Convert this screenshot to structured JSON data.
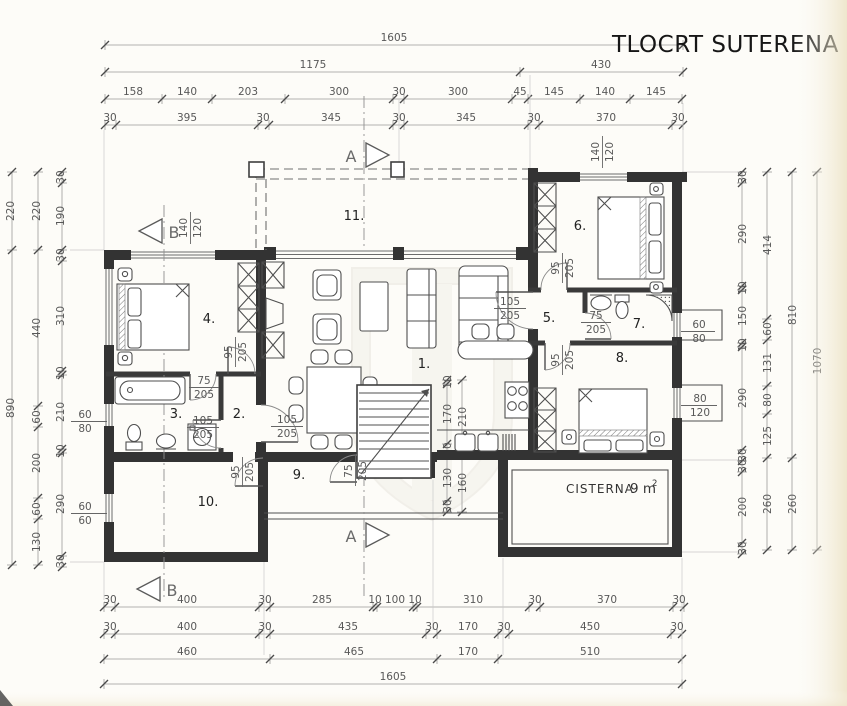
{
  "title": "TLOCRT SUTERENA 1:10",
  "colors": {
    "ink": "#333333",
    "dim_text": "#585858",
    "paper": "#fdfcf8"
  },
  "rooms": [
    "1.",
    "2.",
    "3.",
    "4.",
    "5.",
    "6.",
    "7.",
    "8.",
    "9.",
    "10.",
    "11."
  ],
  "sections": {
    "a": "A",
    "b": "B"
  },
  "cisterna": {
    "name": "CISTERNA",
    "area": "9 m",
    "sup": "2"
  },
  "dims": {
    "top_total": "1605",
    "top_sub": [
      "1175",
      "430"
    ],
    "top_row3": [
      "158",
      "140",
      "203",
      "300",
      "30",
      "300",
      "45",
      "145",
      "140",
      "145"
    ],
    "top_row4": [
      "30",
      "395",
      "30",
      "345",
      "30",
      "345",
      "30",
      "370",
      "30"
    ],
    "bottom_row1": [
      "30",
      "400",
      "30",
      "285",
      "10",
      "100",
      "10",
      "310",
      "30",
      "370",
      "30"
    ],
    "bottom_row2": [
      "30",
      "400",
      "30",
      "435",
      "30",
      "170",
      "30",
      "450",
      "30"
    ],
    "bottom_row3": [
      "460",
      "465",
      "170",
      "510"
    ],
    "bottom_total": "1605",
    "left_col1": [
      "220",
      "890"
    ],
    "left_col2": [
      "220",
      "440",
      "60",
      "200",
      "60",
      "130"
    ],
    "left_col3": [
      "30",
      "190",
      "30",
      "310",
      "10",
      "210",
      "10",
      "290",
      "30"
    ],
    "right_col1": [
      "30",
      "290",
      "10",
      "150",
      "10",
      "290",
      "30",
      "30",
      "200",
      "30"
    ],
    "right_col2": [
      "414",
      "60",
      "131",
      "80",
      "125",
      "260"
    ],
    "right_col3": [
      "810",
      "260"
    ],
    "right_col4": [
      "1070"
    ],
    "inner_v1": [
      "10",
      "170",
      "30",
      "130",
      "30"
    ],
    "inner_v2": [
      "210",
      "160"
    ]
  },
  "doors": [
    {
      "w": "95",
      "h": "205"
    },
    {
      "w": "75",
      "h": "205"
    },
    {
      "w": "105",
      "h": "205"
    },
    {
      "w": "105",
      "h": "205"
    },
    {
      "w": "95",
      "h": "205"
    },
    {
      "w": "75",
      "h": "205"
    },
    {
      "w": "105",
      "h": "205"
    },
    {
      "w": "95",
      "h": "205"
    },
    {
      "w": "75",
      "h": "205"
    },
    {
      "w": "95",
      "h": "205"
    }
  ],
  "windows": [
    {
      "w": "140",
      "h": "120"
    },
    {
      "w": "140",
      "h": "120"
    },
    {
      "w": "60",
      "h": "80"
    },
    {
      "w": "60",
      "h": "60"
    },
    {
      "w": "60",
      "h": "80"
    },
    {
      "w": "80",
      "h": "120"
    }
  ]
}
